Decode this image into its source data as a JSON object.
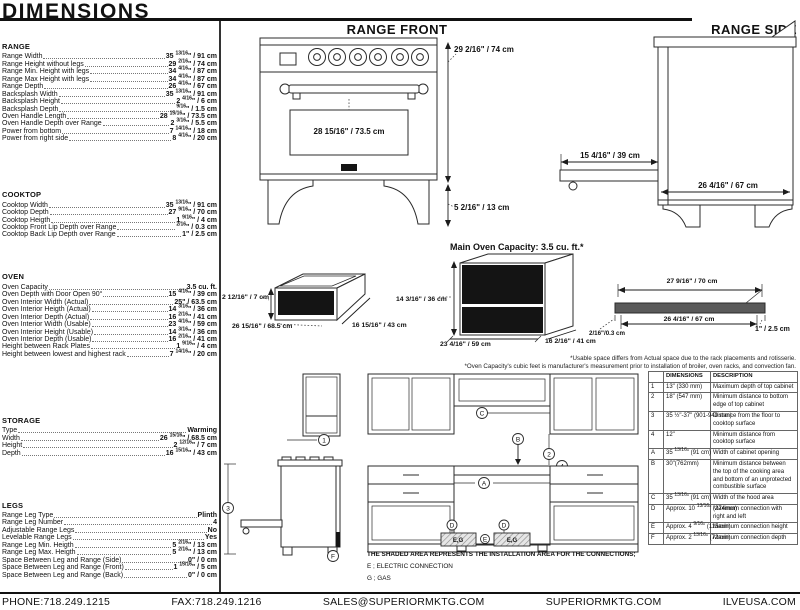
{
  "title": "DIMENSIONS",
  "headings": {
    "front": "RANGE FRONT",
    "side": "RANGE SIDE",
    "capacity": "Main Oven Capacity: 3.5 cu. ft.*"
  },
  "sections": [
    {
      "id": "range",
      "name": "RANGE",
      "items": [
        {
          "label": "Range Width",
          "value": "35 13/16\" / 91 cm"
        },
        {
          "label": "Range Height without legs",
          "value": "29 2/16\" / 74 cm"
        },
        {
          "label": "Range Min. Height with legs",
          "value": "34 4/16\" / 87 cm"
        },
        {
          "label": "Range Max Height with legs",
          "value": "34 4/16\" / 87 cm"
        },
        {
          "label": "Range Depth",
          "value": "26 4/16\" / 67 cm"
        },
        {
          "label": "Backsplash Width",
          "value": "35 13/16\" / 91 cm"
        },
        {
          "label": "Backsplash Height",
          "value": "2 4/16\" / 6 cm"
        },
        {
          "label": "Backsplash Depth",
          "value": "9/16\" / 1.5 cm"
        },
        {
          "label": "Oven Handle Length",
          "value": "28 15/16\" / 73.5 cm"
        },
        {
          "label": "Oven Handle Depth over Range",
          "value": "2 3/16\" / 5.5 cm"
        },
        {
          "label": "Power from bottom",
          "value": "7 14/16\" / 18 cm"
        },
        {
          "label": "Power from right side",
          "value": "8 4/16\" / 20 cm"
        }
      ]
    },
    {
      "id": "cooktop",
      "name": "COOKTOP",
      "items": [
        {
          "label": "Cooktop Width",
          "value": "35 13/16\" / 91 cm"
        },
        {
          "label": "Cooktop Depth",
          "value": "27 9/16\" / 70 cm"
        },
        {
          "label": "Cooktop Heigth",
          "value": "1 9/16\" / 4 cm"
        },
        {
          "label": "Cooktop Front Lip Depth over Range",
          "value": "2/16\" / 0.3 cm"
        },
        {
          "label": "Cooktop Back Lip Depth over Range",
          "value": "1\" / 2.5 cm"
        }
      ]
    },
    {
      "id": "oven",
      "name": "OVEN",
      "items": [
        {
          "label": "Oven Capacity",
          "value": "3.5 cu. ft."
        },
        {
          "label": "Oven Depth with Door Open 90°",
          "value": "15 4/16\" / 39 cm"
        },
        {
          "label": "Oven Interior Width (Actual)",
          "value": "25\" / 63.5 cm"
        },
        {
          "label": "Oven Interior Heigth (Actual)",
          "value": "14 3/16\" / 36 cm"
        },
        {
          "label": "Oven Interior Depth (Actual)",
          "value": "16 2/16\" / 41 cm"
        },
        {
          "label": "Oven Interior Width (Usable)",
          "value": "23 4/16\" / 59 cm"
        },
        {
          "label": "Oven Interior Height (Usable)",
          "value": "14 3/16\" / 36 cm"
        },
        {
          "label": "Oven Interior Depth (Usable)",
          "value": "16 2/16\" / 41 cm"
        },
        {
          "label": "Height between Rack Plates",
          "value": "1 9/16\" / 4 cm"
        },
        {
          "label": "Height between lowest and highest rack",
          "value": "7 14/16\" / 20 cm"
        }
      ]
    },
    {
      "id": "storage",
      "name": "STORAGE",
      "items": [
        {
          "label": "Type",
          "value": "Warming"
        },
        {
          "label": "Width",
          "value": "26 15/16\" / 68.5 cm"
        },
        {
          "label": "Height",
          "value": "2 12/16\" / 7 cm"
        },
        {
          "label": "Depth",
          "value": "16 15/16\" / 43 cm"
        }
      ]
    },
    {
      "id": "legs",
      "name": "LEGS",
      "items": [
        {
          "label": "Range Leg Type",
          "value": "Plinth"
        },
        {
          "label": "Range Leg Number",
          "value": "4"
        },
        {
          "label": "Adjustable Range Legs",
          "value": "No"
        },
        {
          "label": "Levelable Range Legs",
          "value": "Yes"
        },
        {
          "label": "Range Leg Min. Heigth",
          "value": "5 2/16\" / 13 cm"
        },
        {
          "label": "Range Leg Max. Heigth",
          "value": "5 2/16\" / 13 cm"
        },
        {
          "label": "Space Between Leg and Range (Side)",
          "value": "0\" / 0 cm"
        },
        {
          "label": "Space Between Leg and Range (Front)",
          "value": "1 15/16\" / 5 cm"
        },
        {
          "label": "Space Between Leg and Range (Back)",
          "value": "0\" / 0 cm"
        }
      ]
    }
  ],
  "front": {
    "height": "29 2/16\" / 74 cm",
    "legs_height": "5 2/16\" / 13 cm",
    "handle": "28 15/16\" / 73.5 cm"
  },
  "side": {
    "door_open": "15 4/16\" / 39 cm",
    "depth": "26 4/16\" / 67 cm"
  },
  "drawer": {
    "height": "2 12/16\" / 7 cm",
    "width": "26 15/16\" / 68.5 cm",
    "depth": "16 15/16\" / 43 cm"
  },
  "oven_box": {
    "height": "14 3/16\" / 36 cm",
    "width": "23 4/16\" / 59 cm",
    "depth": "16 2/16\" / 41 cm"
  },
  "profile": {
    "top": "27 9/16\" / 70 cm",
    "bottom": "26 4/16\" / 67 cm",
    "front_lip": "2/16\"/0.3 cm",
    "back_lip": "1\" / 2.5 cm"
  },
  "footnotes": {
    "line1": "*Usable space differs from Actual space due to the rack placements and rotisserie.",
    "line2": "*Oven Capacity's cubic feet is manufacturer's measurement prior to installation of broiler, oven racks, and convection fan."
  },
  "install": {
    "note": "THE SHADED AREA REPRESENTS THE INSTALLATION AREA FOR THE CONNECTIONS;",
    "legend_e": "E ; ELECTRIC CONNECTION",
    "legend_g": "G ; GAS",
    "shaded_label": "E,G",
    "markers": {
      "m1": "1",
      "m2": "2",
      "m3": "3",
      "m4": "4",
      "ma": "A",
      "mb": "B",
      "mc": "C",
      "md": "D",
      "me": "E",
      "mf": "F"
    }
  },
  "table": {
    "headers": [
      "",
      "DIMENSIONS",
      "DESCRIPTION"
    ],
    "rows": [
      [
        "1",
        "13\" (330 mm)",
        "Maximum depth of top cabinet"
      ],
      [
        "2",
        "18\" (547 mm)",
        "Minimum distance to bottom edge of top cabinet"
      ],
      [
        "3",
        "35 ½\"-37\" (901-940 mm)",
        "Distance from the floor to cooktop surface"
      ],
      [
        "4",
        "12\"",
        "Minimum distance from cooktop surface"
      ],
      [
        "A",
        "35 13/16\" (91 cm)",
        "Width of cabinet opening"
      ],
      [
        "B",
        "30\"(762mm)",
        "Minimum distance between the top of the cooking area and bottom of an unprotected combustible surface"
      ],
      [
        "C",
        "35 13/16\" (91 cm)",
        "Width of the hood area"
      ],
      [
        "D",
        "Approx. 10 13/16\" (274mm)",
        "Maximum connection with right and left"
      ],
      [
        "E",
        "Approx. 4 9/16\" (115mm)",
        "Maximum connection height"
      ],
      [
        "F",
        "Approx. 2 13/16\" (72mm)",
        "Maximum connection depth"
      ]
    ]
  },
  "footer": {
    "items": [
      "PHONE:718.249.1215",
      "FAX:718.249.1216",
      "SALES@SUPERIORMKTG.COM",
      "SUPERIORMKTG.COM",
      "ILVEUSA.COM"
    ]
  }
}
